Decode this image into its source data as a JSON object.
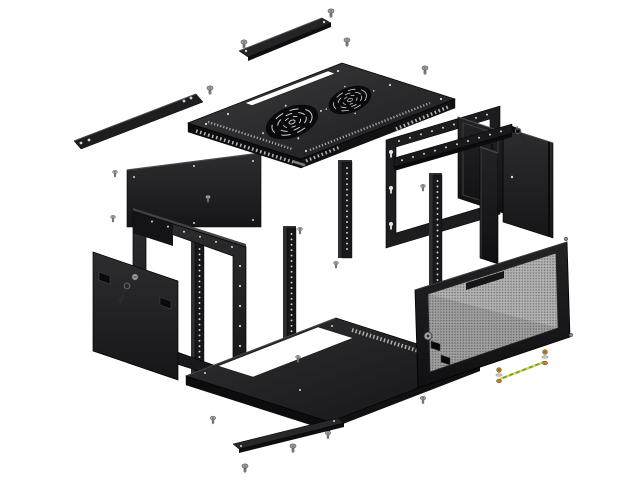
{
  "scene": {
    "kind": "exploded-view technical illustration",
    "subject": "wall-mount network rack cabinet with parts separated",
    "background": "#ffffff"
  },
  "palette": {
    "background": "#ffffff",
    "panel_dark": "#161618",
    "panel_mid": "#242427",
    "panel_light": "#3c3c3f",
    "edge_highlight": "#4a4a4d",
    "outline": "#000000",
    "hole_dot": "#d6d6d8",
    "vent_light": "#c6c6c8",
    "mesh_gray": "#b2b2b2",
    "mesh_dot": "#6a6a6a",
    "screw_gray": "#b5b5b7",
    "screw_shaft": "#8e8e90",
    "brass": "#b58431",
    "washer_silver": "#c9c9cb",
    "ground_wire_green": "#7da32c",
    "ground_wire_yellow": "#d6d655",
    "lock_gray": "#a2a2a4",
    "white_cutout": "#ffffff"
  },
  "parts": [
    {
      "id": "wall-mount-bracket",
      "desc": "long wall bar with screw holes, upper left",
      "count": 1
    },
    {
      "id": "top-cable-cover",
      "desc": "narrow cover strip floating above roof slot",
      "count": 1
    },
    {
      "id": "top-panel",
      "desc": "roof panel with two fan grilles, cable slot and perforated vents",
      "count": 1
    },
    {
      "id": "fan-grille",
      "desc": "round swirl fan grille cutout",
      "count": 2
    },
    {
      "id": "rear-panel",
      "desc": "large flat panel, upper left of frame",
      "count": 1
    },
    {
      "id": "wall-frame",
      "desc": "rear mounting ring with keyhole slots",
      "count": 1
    },
    {
      "id": "rack-rail",
      "desc": "vertical mounting rail with hole column",
      "count": 4
    },
    {
      "id": "side-bar",
      "desc": "horizontal rail with cage-nut holes",
      "count": 1
    },
    {
      "id": "side-panel-right-front",
      "desc": "right side panel with cam lock",
      "count": 1
    },
    {
      "id": "side-panel-right-back",
      "desc": "right side panel, outer",
      "count": 1
    },
    {
      "id": "key",
      "desc": "key with ring hanging at right panel",
      "count": 1
    },
    {
      "id": "front-frame",
      "desc": "front rectangular frame ring",
      "count": 1
    },
    {
      "id": "left-door",
      "desc": "solid side door with cam lock and key",
      "count": 1
    },
    {
      "id": "bottom-panel",
      "desc": "base tray with white cable cutout and vent band",
      "count": 1
    },
    {
      "id": "bottom-cable-cover",
      "desc": "narrow cover strip below base",
      "count": 1
    },
    {
      "id": "mesh-door",
      "desc": "perforated front door with lock, clips and hinge pins",
      "count": 1
    },
    {
      "id": "grounding-wire",
      "desc": "green-yellow earth wire with brass screw terminals",
      "count": 1
    },
    {
      "id": "screw",
      "desc": "loose mounting screw",
      "count": 17
    }
  ]
}
